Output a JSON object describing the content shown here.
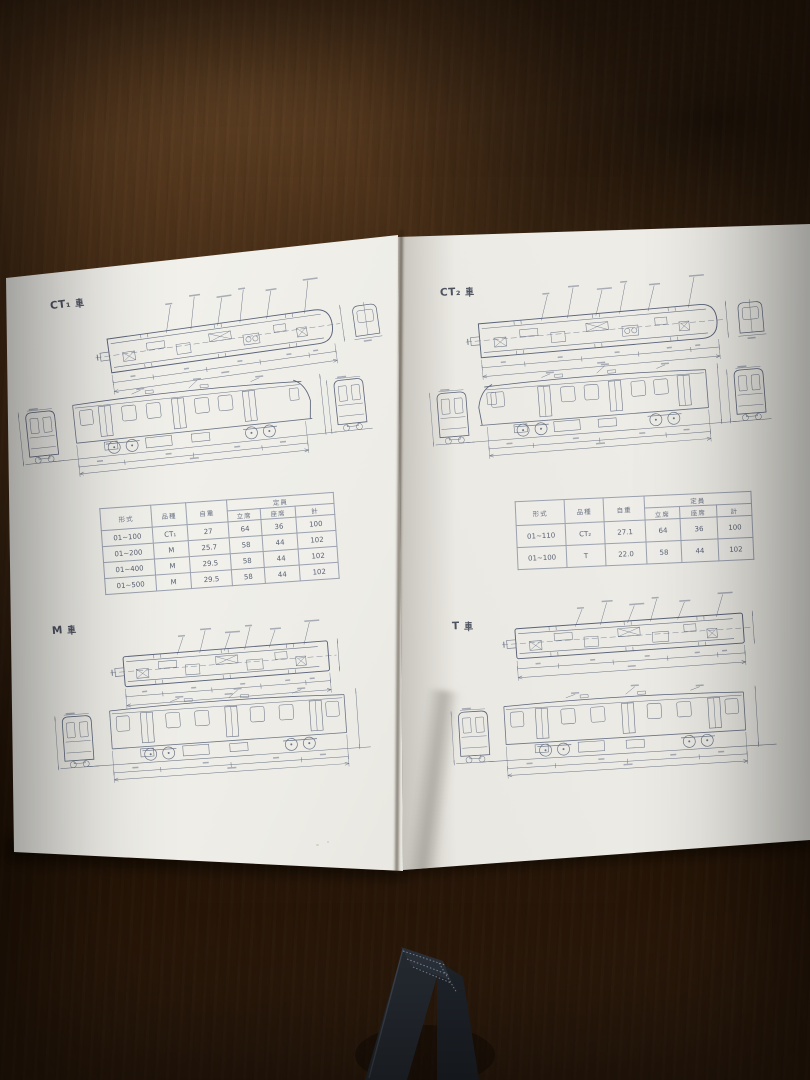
{
  "left_page": {
    "section_ct1": {
      "title": "CT₁車",
      "title_prefix": "CT₁"
    },
    "section_m": {
      "title": "M 車",
      "title_prefix": "M"
    },
    "table": {
      "headers": {
        "model": "形式",
        "series": "品種",
        "weight": "自重",
        "capacity": "定員",
        "standing": "立席",
        "seated": "座席",
        "total": "計"
      },
      "rows": [
        {
          "model": "01~100",
          "series": "CT₁",
          "weight": "27",
          "standing": "64",
          "seated": "36",
          "total": "100"
        },
        {
          "model": "01~200",
          "series": "M",
          "weight": "25.7",
          "standing": "58",
          "seated": "44",
          "total": "102"
        },
        {
          "model": "01~400",
          "series": "M",
          "weight": "29.5",
          "standing": "58",
          "seated": "44",
          "total": "102"
        },
        {
          "model": "01~500",
          "series": "M",
          "weight": "29.5",
          "standing": "58",
          "seated": "44",
          "total": "102"
        }
      ]
    }
  },
  "right_page": {
    "section_ct2": {
      "title": "CT₂車",
      "title_prefix": "CT₂"
    },
    "section_t": {
      "title": "T 車",
      "title_prefix": "T"
    },
    "table": {
      "headers": {
        "model": "形式",
        "series": "品種",
        "weight": "自重",
        "capacity": "定員",
        "standing": "立席",
        "seated": "座席",
        "total": "計"
      },
      "rows": [
        {
          "model": "01~110",
          "series": "CT₂",
          "weight": "27.1",
          "standing": "64",
          "seated": "36",
          "total": "100"
        },
        {
          "model": "01~100",
          "series": "T",
          "weight": "22.0",
          "standing": "58",
          "seated": "44",
          "total": "102"
        }
      ]
    }
  }
}
